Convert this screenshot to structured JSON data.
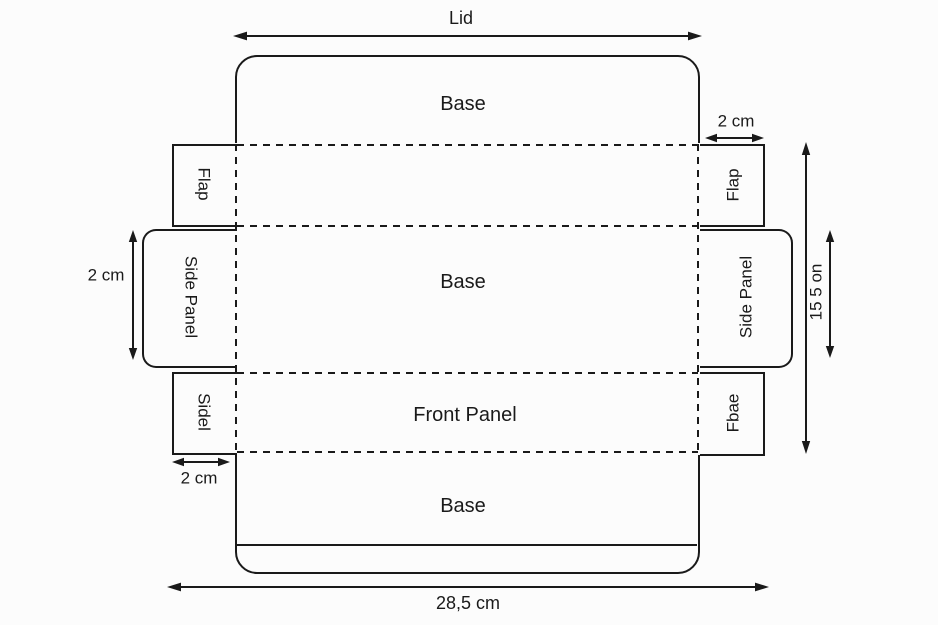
{
  "colors": {
    "line": "#1a1a1a",
    "background": "#fcfcfc"
  },
  "panels": {
    "lid": "Lid",
    "base_top": "Base",
    "base_middle": "Base",
    "front_panel": "Front Panel",
    "base_bottom": "Base",
    "flap_left": "Flap",
    "flap_right": "Flap",
    "side_panel_left": "Side Panel",
    "side_panel_right": "Side Panel",
    "side_tab_bottom_left": "Sidel",
    "side_tab_bottom_right": "Fbae"
  },
  "dimensions": {
    "tab_width_top_right": "2 cm",
    "side_panel_depth_left": "2 cm",
    "tab_width_bottom_left": "2 cm",
    "height_right": "15 5 on",
    "total_width_bottom": "28,5 cm"
  }
}
